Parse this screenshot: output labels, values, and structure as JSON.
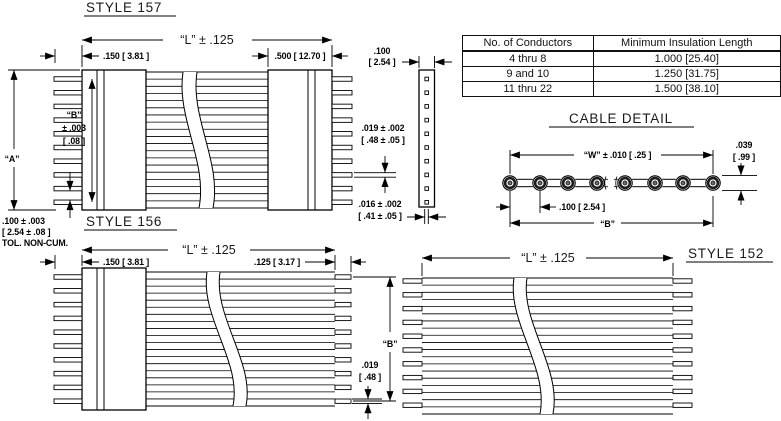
{
  "colors": {
    "ink": "#000000",
    "paper": "#ffffff"
  },
  "style157": {
    "title": "STYLE 157",
    "dim_length": "“L” ± .125",
    "dim_width_left": ".150 [ 3.81 ]",
    "dim_width_right": ".500 [ 12.70 ]",
    "dim_thickness_line1": ".100",
    "dim_thickness_line2": "[ 2.54 ]",
    "dim_pin_thk_line1": ".019 ± .002",
    "dim_pin_thk_line2": "[ .48 ± .05 ]",
    "dim_pin_w_line1": ".016 ± .002",
    "dim_pin_w_line2": "[ .41 ± .05 ]",
    "label_a": "“A”",
    "label_b_line1": "“B”",
    "label_b_line2": "± .003",
    "label_b_line3": "[ .08 ]",
    "pitch_line1": ".100 ± .003",
    "pitch_line2": "[ 2.54 ± .08 ]",
    "pitch_line3": "TOL. NON-CUM."
  },
  "conductor_table": {
    "headers": [
      "No. of Conductors",
      "Minimum Insulation Length"
    ],
    "rows": [
      [
        "4 thru 8",
        "1.000 [25.40]"
      ],
      [
        "9 and 10",
        "1.250 [31.75]"
      ],
      [
        "11 thru 22",
        "1.500 [38.10]"
      ]
    ]
  },
  "cable_detail": {
    "title": "CABLE DETAIL",
    "dim_w": "“W” ± .010 [ .25 ]",
    "dim_h_line1": ".039",
    "dim_h_line2": "[ .99 ]",
    "dim_pitch": ".100 [ 2.54 ]",
    "label_b": "“B”"
  },
  "style156": {
    "title": "STYLE 156",
    "dim_length": "“L” ± .125",
    "dim_width_left": ".150 [ 3.81 ]",
    "dim_strip": ".125 [ 3.17 ]",
    "label_b": "“B”",
    "dim_wire_line1": ".019",
    "dim_wire_line2": "[ .48 ]"
  },
  "style152": {
    "title": "STYLE 152",
    "dim_length": "“L” ± .125"
  }
}
